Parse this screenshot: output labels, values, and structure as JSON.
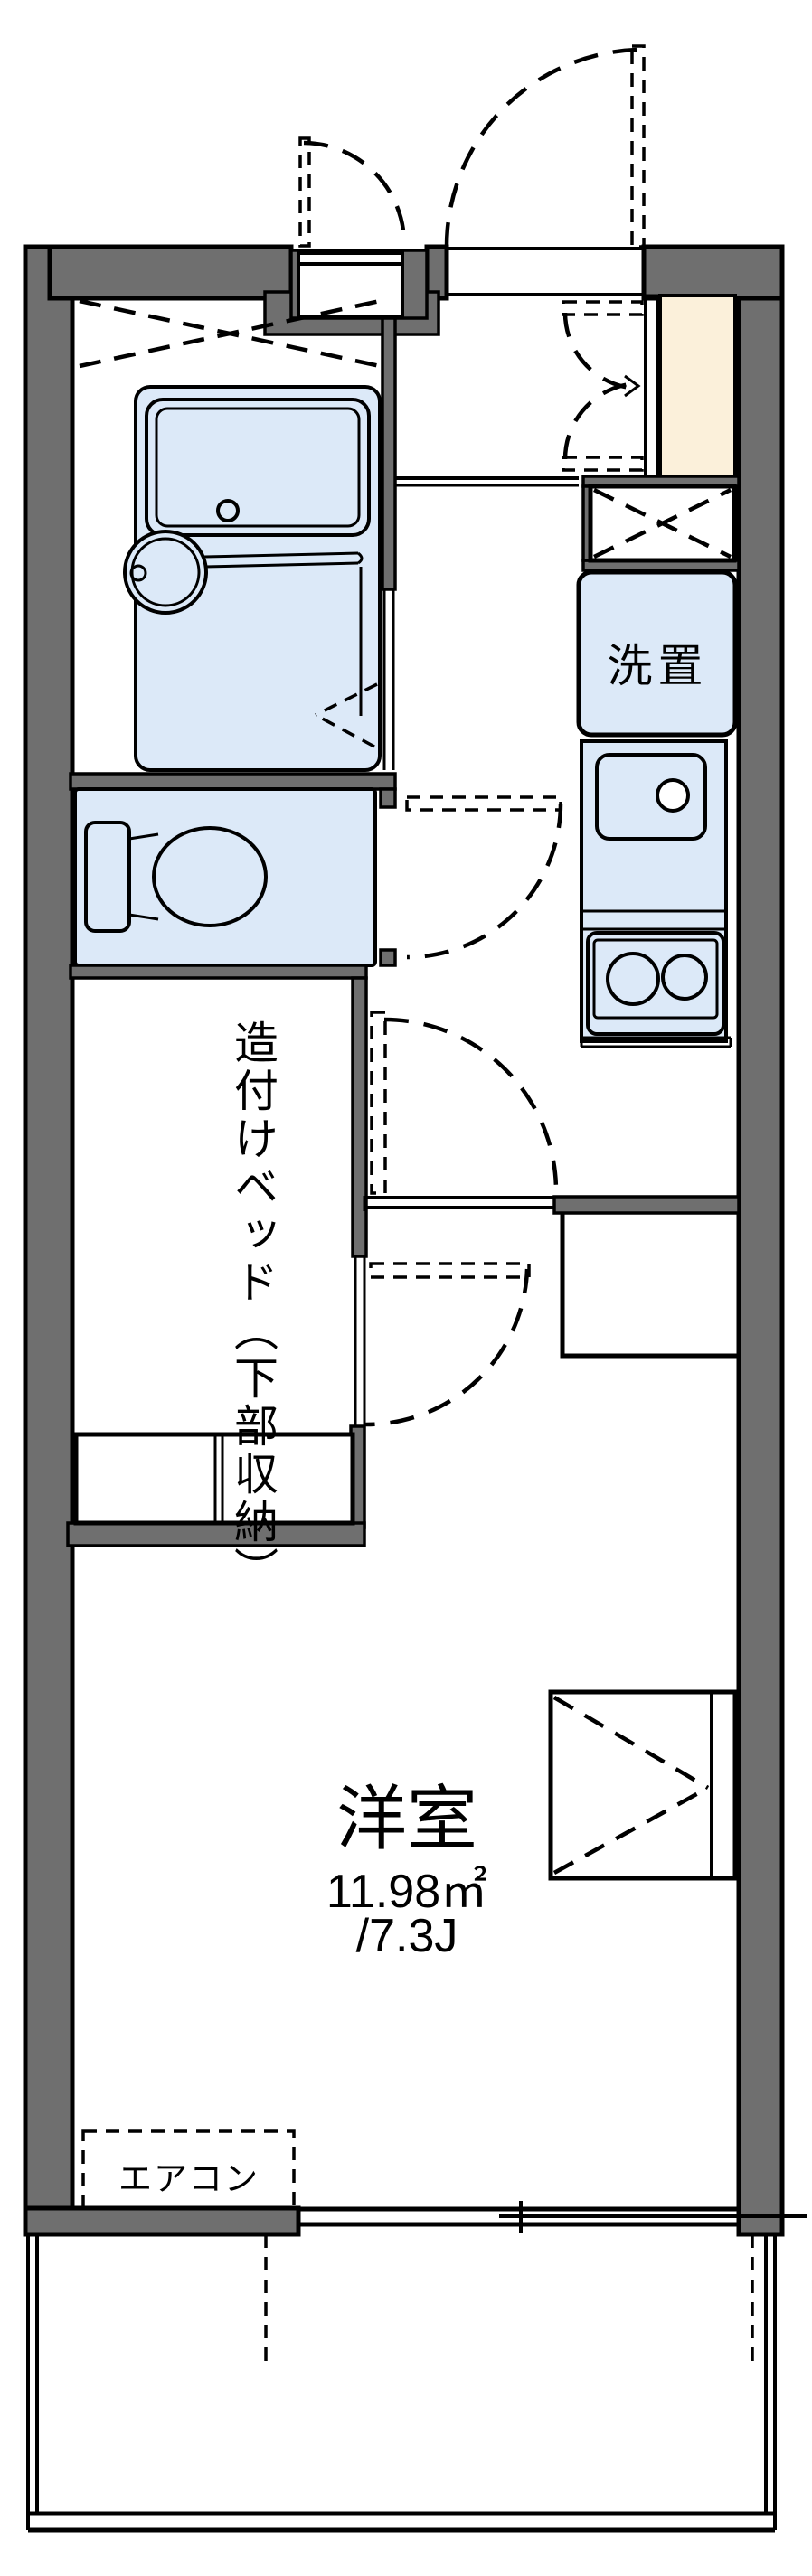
{
  "labels": {
    "built_in_bed": "造付けベッド（下部収納）",
    "washer": "洗置",
    "room_name": "洋室",
    "room_area_m2": "11.98㎡",
    "room_area_tatami": "/7.3J",
    "aircon": "エアコン"
  },
  "colors": {
    "wall": "#6f6f6f",
    "fixture_fill": "#dce9f8",
    "shoe_cabinet_fill": "#fbf0da",
    "line": "#000000",
    "background": "#ffffff"
  }
}
